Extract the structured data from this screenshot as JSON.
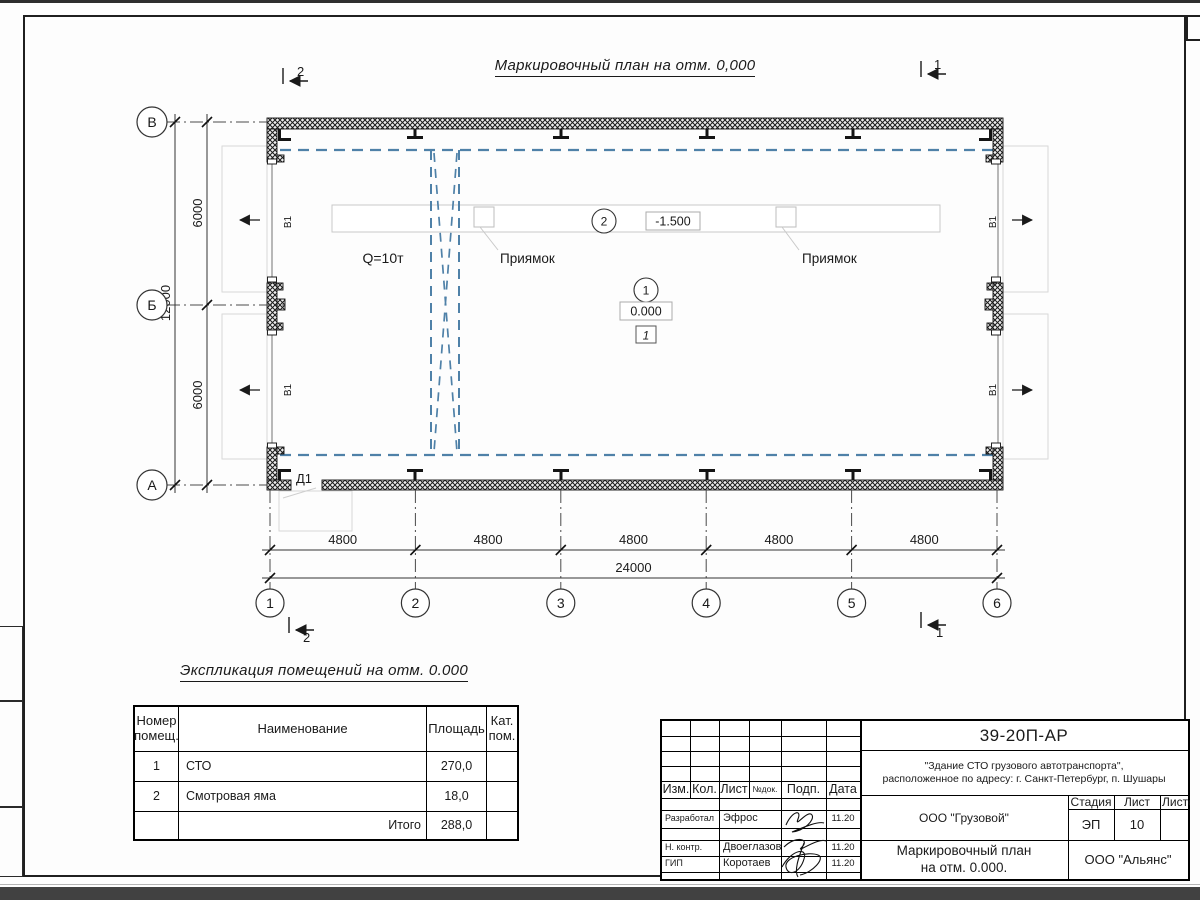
{
  "plan": {
    "title": "Маркировочный план на отм. 0,000",
    "axis_rows": [
      "В",
      "Б",
      "А"
    ],
    "axis_cols": [
      "1",
      "2",
      "3",
      "4",
      "5",
      "6"
    ],
    "dim_h": [
      "4800",
      "4800",
      "4800",
      "4800",
      "4800"
    ],
    "dim_h_total": "24000",
    "dim_v": [
      "6000",
      "6000"
    ],
    "dim_v_total": "12000",
    "section_top_left": "2",
    "section_top_right": "1",
    "section_bottom_left": "2",
    "section_bottom_right": "1",
    "crane_label": "Q=10т",
    "pit_label_left": "Приямок",
    "pit_label_right": "Приямок",
    "door_label": "Д1",
    "window_label": "В1",
    "room1_num": "1",
    "room1_elev": "0.000",
    "room1_floor_type": "1",
    "room2_num": "2",
    "room2_elev": "-1.500"
  },
  "explication": {
    "title": "Экспликация помещений на отм. 0.000",
    "header_num_l1": "Номер",
    "header_num_l2": "помещ.",
    "header_name": "Наименование",
    "header_area": "Площадь",
    "header_cat_l1": "Кат.",
    "header_cat_l2": "пом.",
    "rows": [
      {
        "num": "1",
        "name": "СТО",
        "area": "270,0",
        "cat": ""
      },
      {
        "num": "2",
        "name": "Смотровая яма",
        "area": "18,0",
        "cat": ""
      }
    ],
    "total_label": "Итого",
    "total_area": "288,0"
  },
  "titleblock": {
    "doc_number": "39-20П-АР",
    "project_line1": "\"Здание СТО грузового автотранспорта\",",
    "project_line2": "расположенное по адресу: г. Санкт-Петербург, п. Шушары",
    "client": "ООО \"Грузовой\"",
    "sheet_title_line1": "Маркировочный план",
    "sheet_title_line2": "на отм. 0.000.",
    "company": "ООО \"Альянс\"",
    "stage_label": "Стадия",
    "sheet_label": "Лист",
    "sheets_label": "Листов",
    "stage_value": "ЭП",
    "sheet_value": "10",
    "cols": [
      "Изм.",
      "Кол.",
      "Лист",
      "№док.",
      "Подп.",
      "Дата"
    ],
    "sig_rows": [
      {
        "role": "Разработал",
        "name": "Эфрос",
        "date": "11.20"
      },
      {
        "role": "Н. контр.",
        "name": "Двоеглазов",
        "date": "11.20"
      },
      {
        "role": "ГИП",
        "name": "Коротаев",
        "date": "11.20"
      }
    ]
  },
  "colors": {
    "crane_blue": "#4f81a8",
    "faint_gray": "#c9c9c9",
    "line_black": "#1a1a1a"
  }
}
